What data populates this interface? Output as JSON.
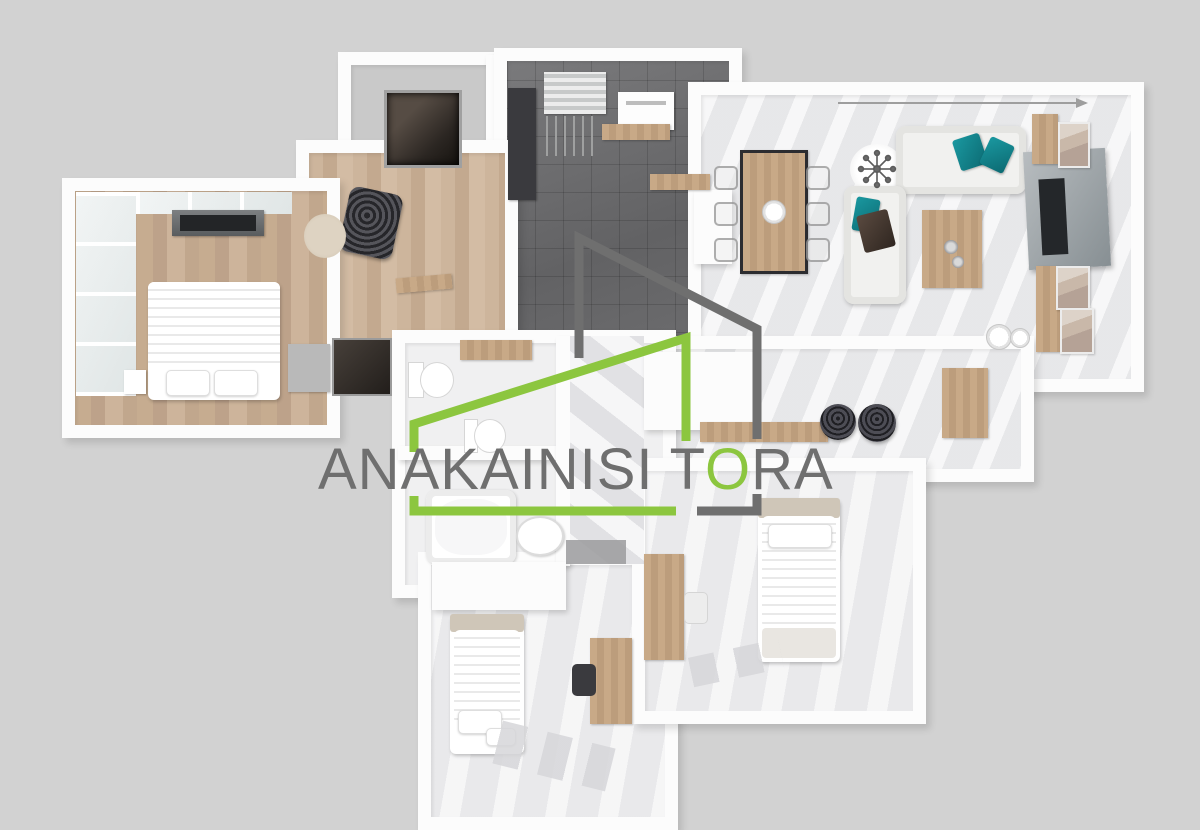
{
  "watermark": {
    "full_text": "ANAKAINISI TORA",
    "before_o": "ANAKAINISI T",
    "o_letter": "O",
    "after_o": "RA"
  },
  "palette": {
    "canvas_background": "#d2d2d2",
    "brand_green": "#8cc63f",
    "brand_gray": "#6f6f6f",
    "accent_teal": "#128691",
    "wall_white": "#fcfcfc",
    "wood_floor": "#c6ac90",
    "dark_tile_floor": "#6a6a6c",
    "marble_floor": "#ebebed"
  },
  "scene": {
    "type": "3d-floor-plan-top-view",
    "rooms": [
      "storage",
      "kitchen",
      "living-dining",
      "entry-hall",
      "master-bedroom",
      "bathroom",
      "second-bathroom",
      "bedroom-left",
      "bedroom-right",
      "bar-area"
    ],
    "furnishings": [
      "double-bed",
      "single-bed-left",
      "single-bed-right",
      "sofa-with-teal-pillows",
      "chaise-sofa",
      "dining-table-with-ghost-chairs",
      "coffee-table",
      "tv-wall-unit",
      "bar-counter-with-stools",
      "bathtub",
      "toilets",
      "washbasin",
      "desks",
      "wardrobe",
      "accent-armchair",
      "washing-machine",
      "chandelier"
    ]
  }
}
